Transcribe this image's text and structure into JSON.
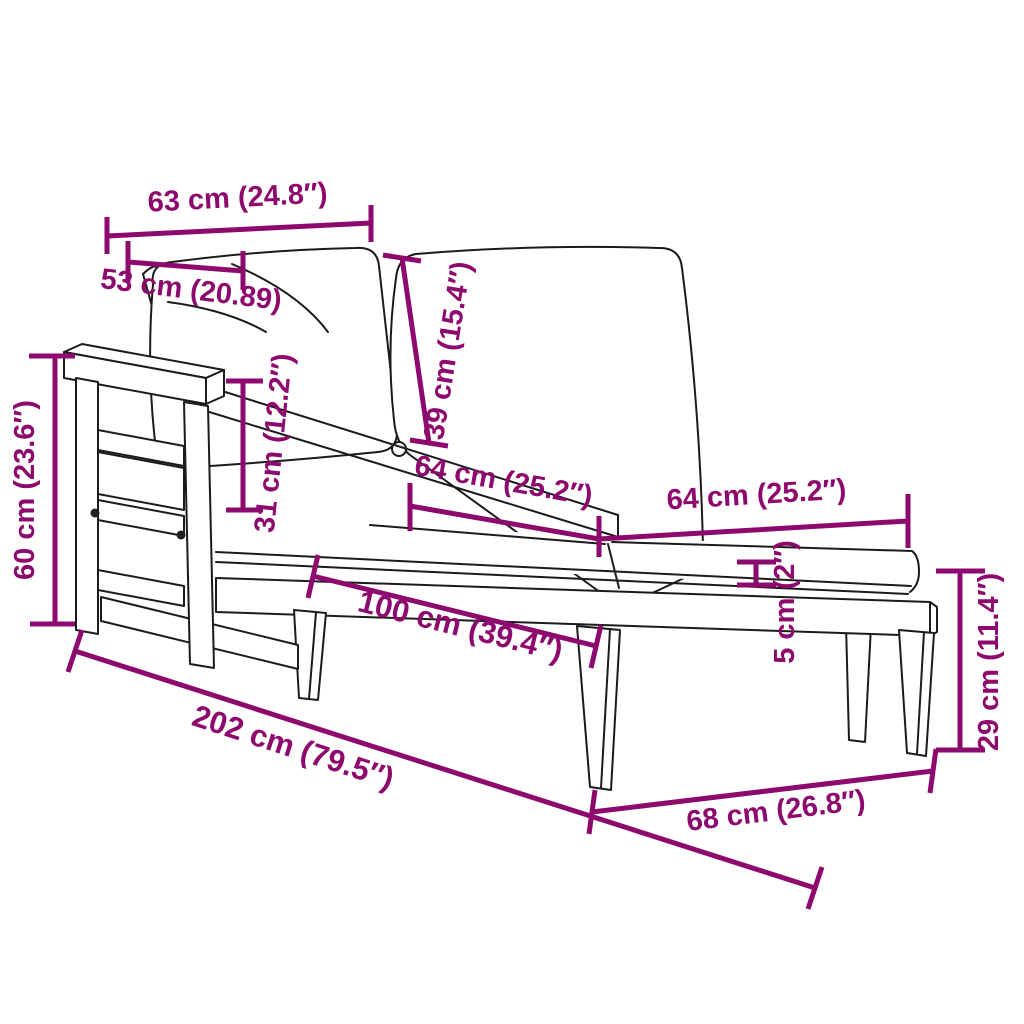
{
  "diagram": {
    "subject": "sun lounger with cushions and pillows - dimension drawing"
  },
  "colors": {
    "dimension": "#8D096E",
    "drawing": "#1B1B1B",
    "background": "#FFFFFF"
  },
  "dimensions": {
    "back_width": {
      "label": "63 cm (24.8″)"
    },
    "pillow_width": {
      "label": "53 cm (20.89)"
    },
    "pillow_height": {
      "label": "39 cm (15.4″)"
    },
    "frame_height": {
      "label": "60 cm (23.6″)"
    },
    "backrest_height": {
      "label": "31 cm (12.2″)"
    },
    "cushion_section_left": {
      "label": "64 cm (25.2″)"
    },
    "cushion_section_right": {
      "label": "64 cm (25.2″)"
    },
    "cushion_thickness": {
      "label": "5 cm (2″)"
    },
    "seat_length": {
      "label": "100 cm (39.4″)"
    },
    "total_length": {
      "label": "202 cm (79.5″)"
    },
    "foot_end_width": {
      "label": "68 cm (26.8″)"
    },
    "leg_height": {
      "label": "29 cm (11.4″)"
    }
  }
}
